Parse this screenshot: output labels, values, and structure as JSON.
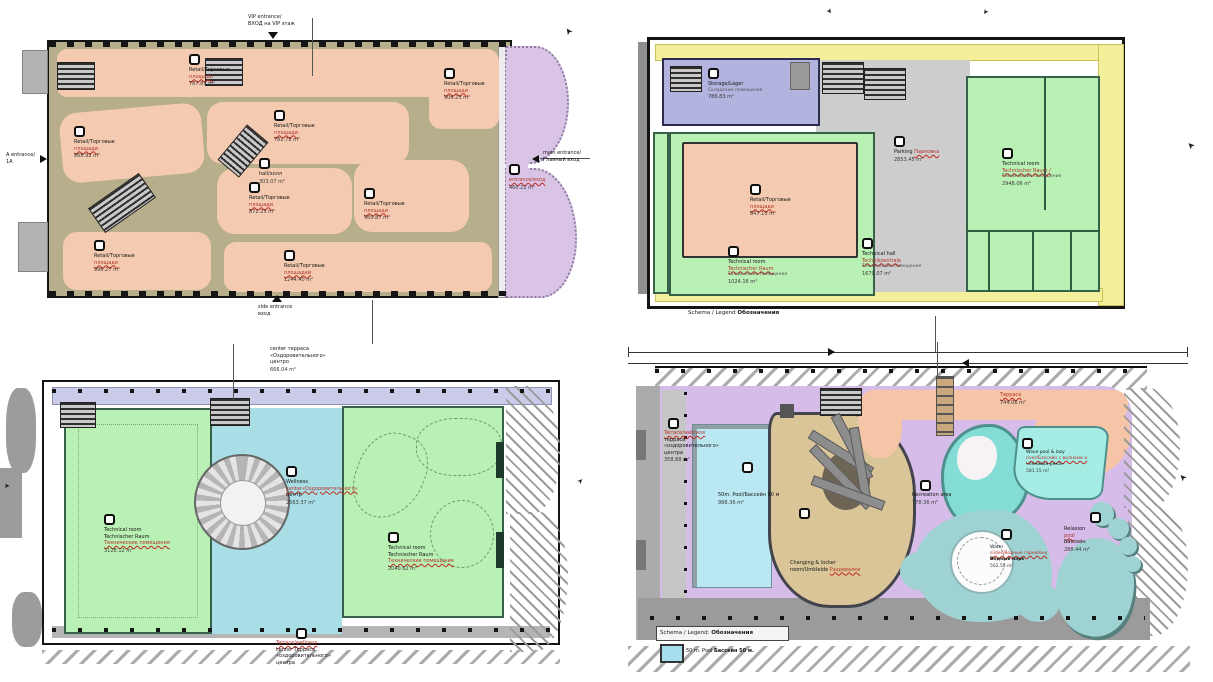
{
  "icons": {
    "section_arrow": "➤"
  },
  "planA": {
    "rooms": [
      {
        "t": "Retail/Торговые",
        "r": "площади",
        "area": "787.81 m²"
      },
      {
        "t": "Retail/Торговые",
        "r": "площади",
        "area": "906.23 m²"
      },
      {
        "t": "Retail/Торговые",
        "r": "площади",
        "area": "868.92 m²"
      },
      {
        "t": "Retail/Торговые",
        "r": "площади",
        "area": "782.78 m²"
      },
      {
        "t": "Retail/Торговые",
        "r": "площади",
        "area": "872.23 m²"
      },
      {
        "t": "Retail/Торговые",
        "r": "площади",
        "area": "960.87 m²"
      },
      {
        "t": "Retail/Торговые",
        "r": "площади",
        "area": "996.27 m²"
      },
      {
        "t": "Retail/Торговые",
        "r": "площадей",
        "area": "1244.40 m²"
      }
    ],
    "hall": {
      "a": "hall/холл",
      "area": "303.07 m²"
    },
    "entrance_hall": {
      "r": "entrance/вход",
      "area": "460.22 m²"
    },
    "vip": {
      "a": "VIP entrance/",
      "b": "ВХОД на VIP этаж"
    },
    "side": {
      "a": "side entrance",
      "b": "вход"
    },
    "a_ent": {
      "a": "A entrance/",
      "b": "1A"
    },
    "main_ent": {
      "a": "main entrance/",
      "b": "Главный вход"
    }
  },
  "planB": {
    "storage": {
      "a": "Storage/Lager",
      "b": "Складские помещения",
      "area": "786.83 m²"
    },
    "parking": {
      "a": "Parking",
      "r": "Парковка",
      "area": "2853.45 m²"
    },
    "retail": {
      "t": "Retail/Торговые",
      "r": "площади",
      "area": "847.13 m²"
    },
    "tech_room_1": {
      "a": "Technical room",
      "r": "Technischer Raum",
      "b": "Технические помещения",
      "area": "1024.16 m²"
    },
    "tech_hall": {
      "a": "Technical hall",
      "r": "Technikzentrale",
      "b": "Технические помещения",
      "area": "1670.07 m²"
    },
    "tech_room_2": {
      "a": "Technical room",
      "r": "Technischer Raum /",
      "b": "Технические помещения",
      "area": "2948.06 m²"
    },
    "legend": {
      "a": "Schema / Legend",
      "b": "Обозначения"
    }
  },
  "planC": {
    "tech_left": {
      "a": "Technical room",
      "b": "Technischer Raum",
      "r": "Технические помещения",
      "area": "3128.12 m²"
    },
    "wellness": {
      "a": "Wellness",
      "r": "center«Оздоровительного»",
      "b": "центр",
      "area": "2563.37 m²"
    },
    "tech_right": {
      "a": "Technical room",
      "b": "Technischer Raum",
      "r": "Технические помещения",
      "area": "2040.62 m²"
    },
    "terrace_top": {
      "a": "center терраса",
      "b": "«Оздоровительного»",
      "c": "центро",
      "area": "666.04 m²"
    },
    "terrace_bottom": {
      "r": "Terrace/wellness",
      "a": "center Терраса",
      "b": "«оздоровительного»",
      "c": "центра"
    }
  },
  "planD": {
    "terrace_left": {
      "r": "Terrace/wellness",
      "a": "терраса",
      "b": "«оздоровительного»",
      "c": "центра",
      "area": "358.88 m²"
    },
    "pool50": {
      "a": "50m. Pool/Бассейн 50 м",
      "area": "988.36 m²"
    },
    "changing": {
      "a": "Changing & locker",
      "b": "room/Umkleide",
      "r": "Раздевалки"
    },
    "terrace_744": {
      "r": "Терраса",
      "area": "744.06 m²"
    },
    "recreation": {
      "a": "Recreation area",
      "area": "778.36 m²"
    },
    "wave": {
      "a": "Wave pool & lazy",
      "r": "river/Бассейн с волнами и",
      "b": "«ленивая река»",
      "area": "581.15 m²"
    },
    "waterpark": {
      "a": "Water",
      "r": "slides/Водные горки/вну",
      "b": "Водный парк",
      "area": "562.55 m²"
    },
    "relax": {
      "a": "Relaxion",
      "r": "pool",
      "b": "Бассейн",
      "area": "288.44 m²"
    },
    "legend": {
      "a": "Schema / Legend:",
      "b": "Обозначения"
    },
    "legend_pool": {
      "a": "50 m. Pool",
      "b": "Бассейн 50 м."
    }
  }
}
